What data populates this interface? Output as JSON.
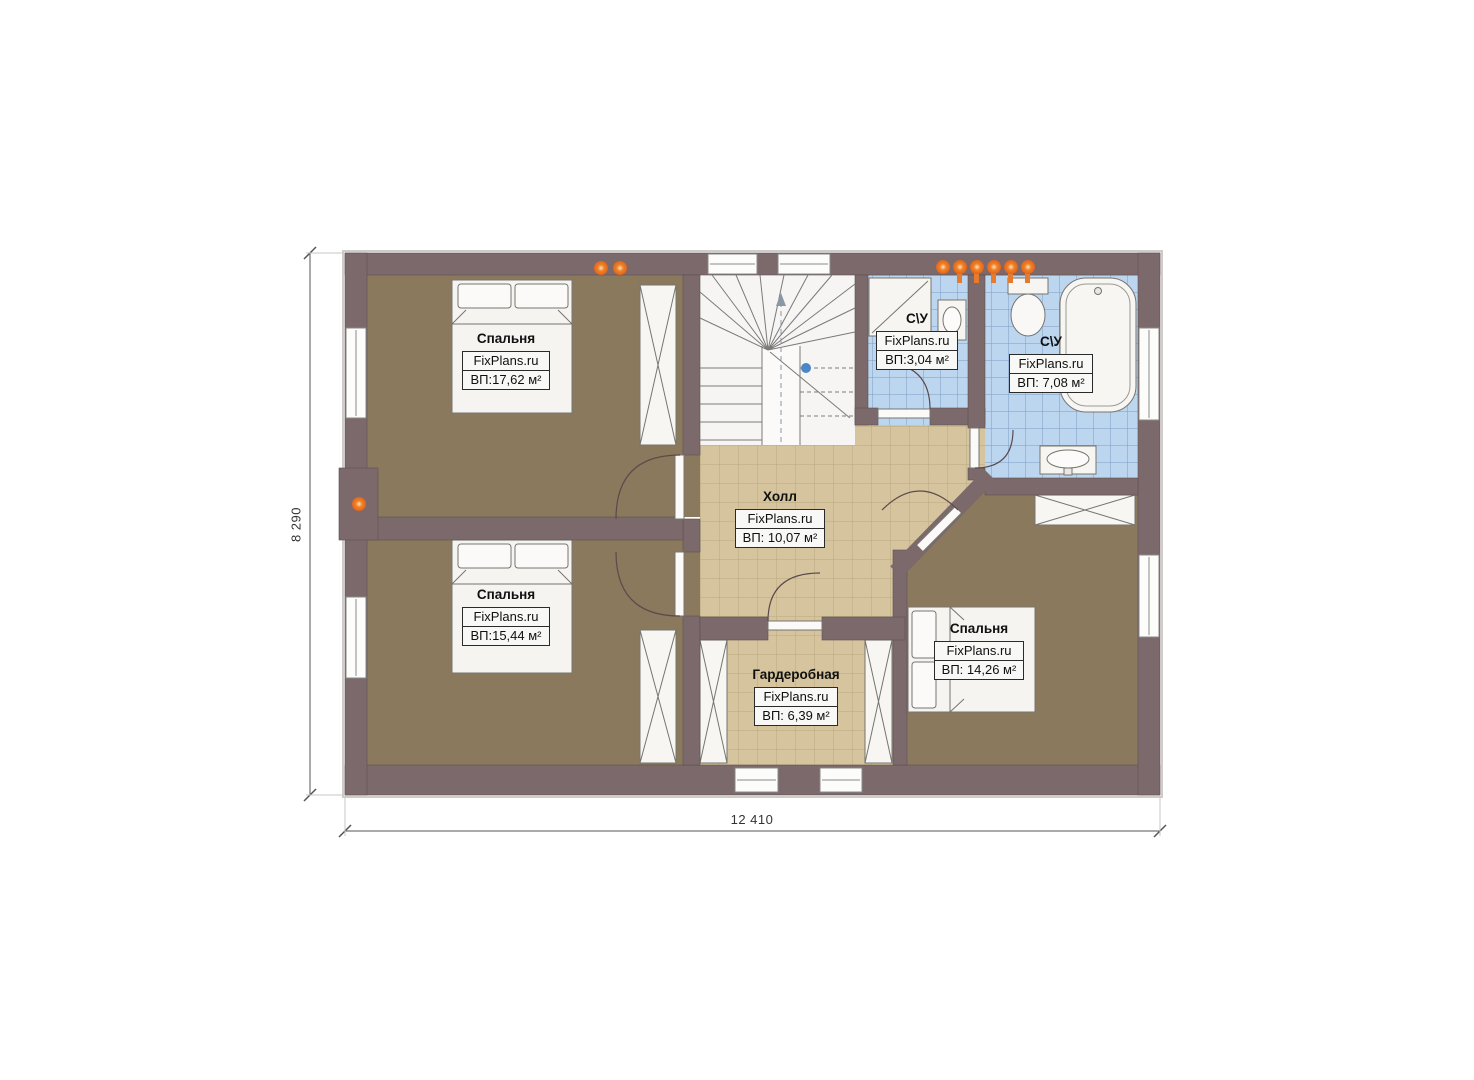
{
  "plan_title": "Floor plan (second floor)",
  "watermark": "FixPlans.ru",
  "rooms": [
    {
      "key": "bedroom_top_left",
      "name": "Спальня",
      "watermark": "FixPlans.ru",
      "area": "ВП:17,62 м²"
    },
    {
      "key": "bedroom_bottom_left",
      "name": "Спальня",
      "watermark": "FixPlans.ru",
      "area": "ВП:15,44 м²"
    },
    {
      "key": "hall",
      "name": "Холл",
      "watermark": "FixPlans.ru",
      "area": "ВП: 10,07 м²"
    },
    {
      "key": "bathroom_small",
      "name": "С\\У",
      "watermark": "FixPlans.ru",
      "area": "ВП:3,04 м²"
    },
    {
      "key": "bathroom_large",
      "name": "С\\У",
      "watermark": "FixPlans.ru",
      "area": "ВП: 7,08 м²"
    },
    {
      "key": "bedroom_right",
      "name": "Спальня",
      "watermark": "FixPlans.ru",
      "area": "ВП: 14,26 м²"
    },
    {
      "key": "wardrobe_room",
      "name": "Гардеробная",
      "watermark": "FixPlans.ru",
      "area": "ВП: 6,39 м²"
    }
  ],
  "dimensions": {
    "overall_width": "12 410",
    "overall_height": "8 290"
  },
  "colors": {
    "wall": "#7b696b",
    "bedroom_floor": "#8a795c",
    "hall_floor": "#d5c49e",
    "hall_grid": "#b9a87f",
    "bath_floor": "#bdd6ef",
    "bath_grid": "#7b9cc4",
    "furniture": "#f6f5f2",
    "accent_orange": "#e8772e",
    "stair_dot_blue": "#4a86c8",
    "dimension_line": "#555555"
  }
}
